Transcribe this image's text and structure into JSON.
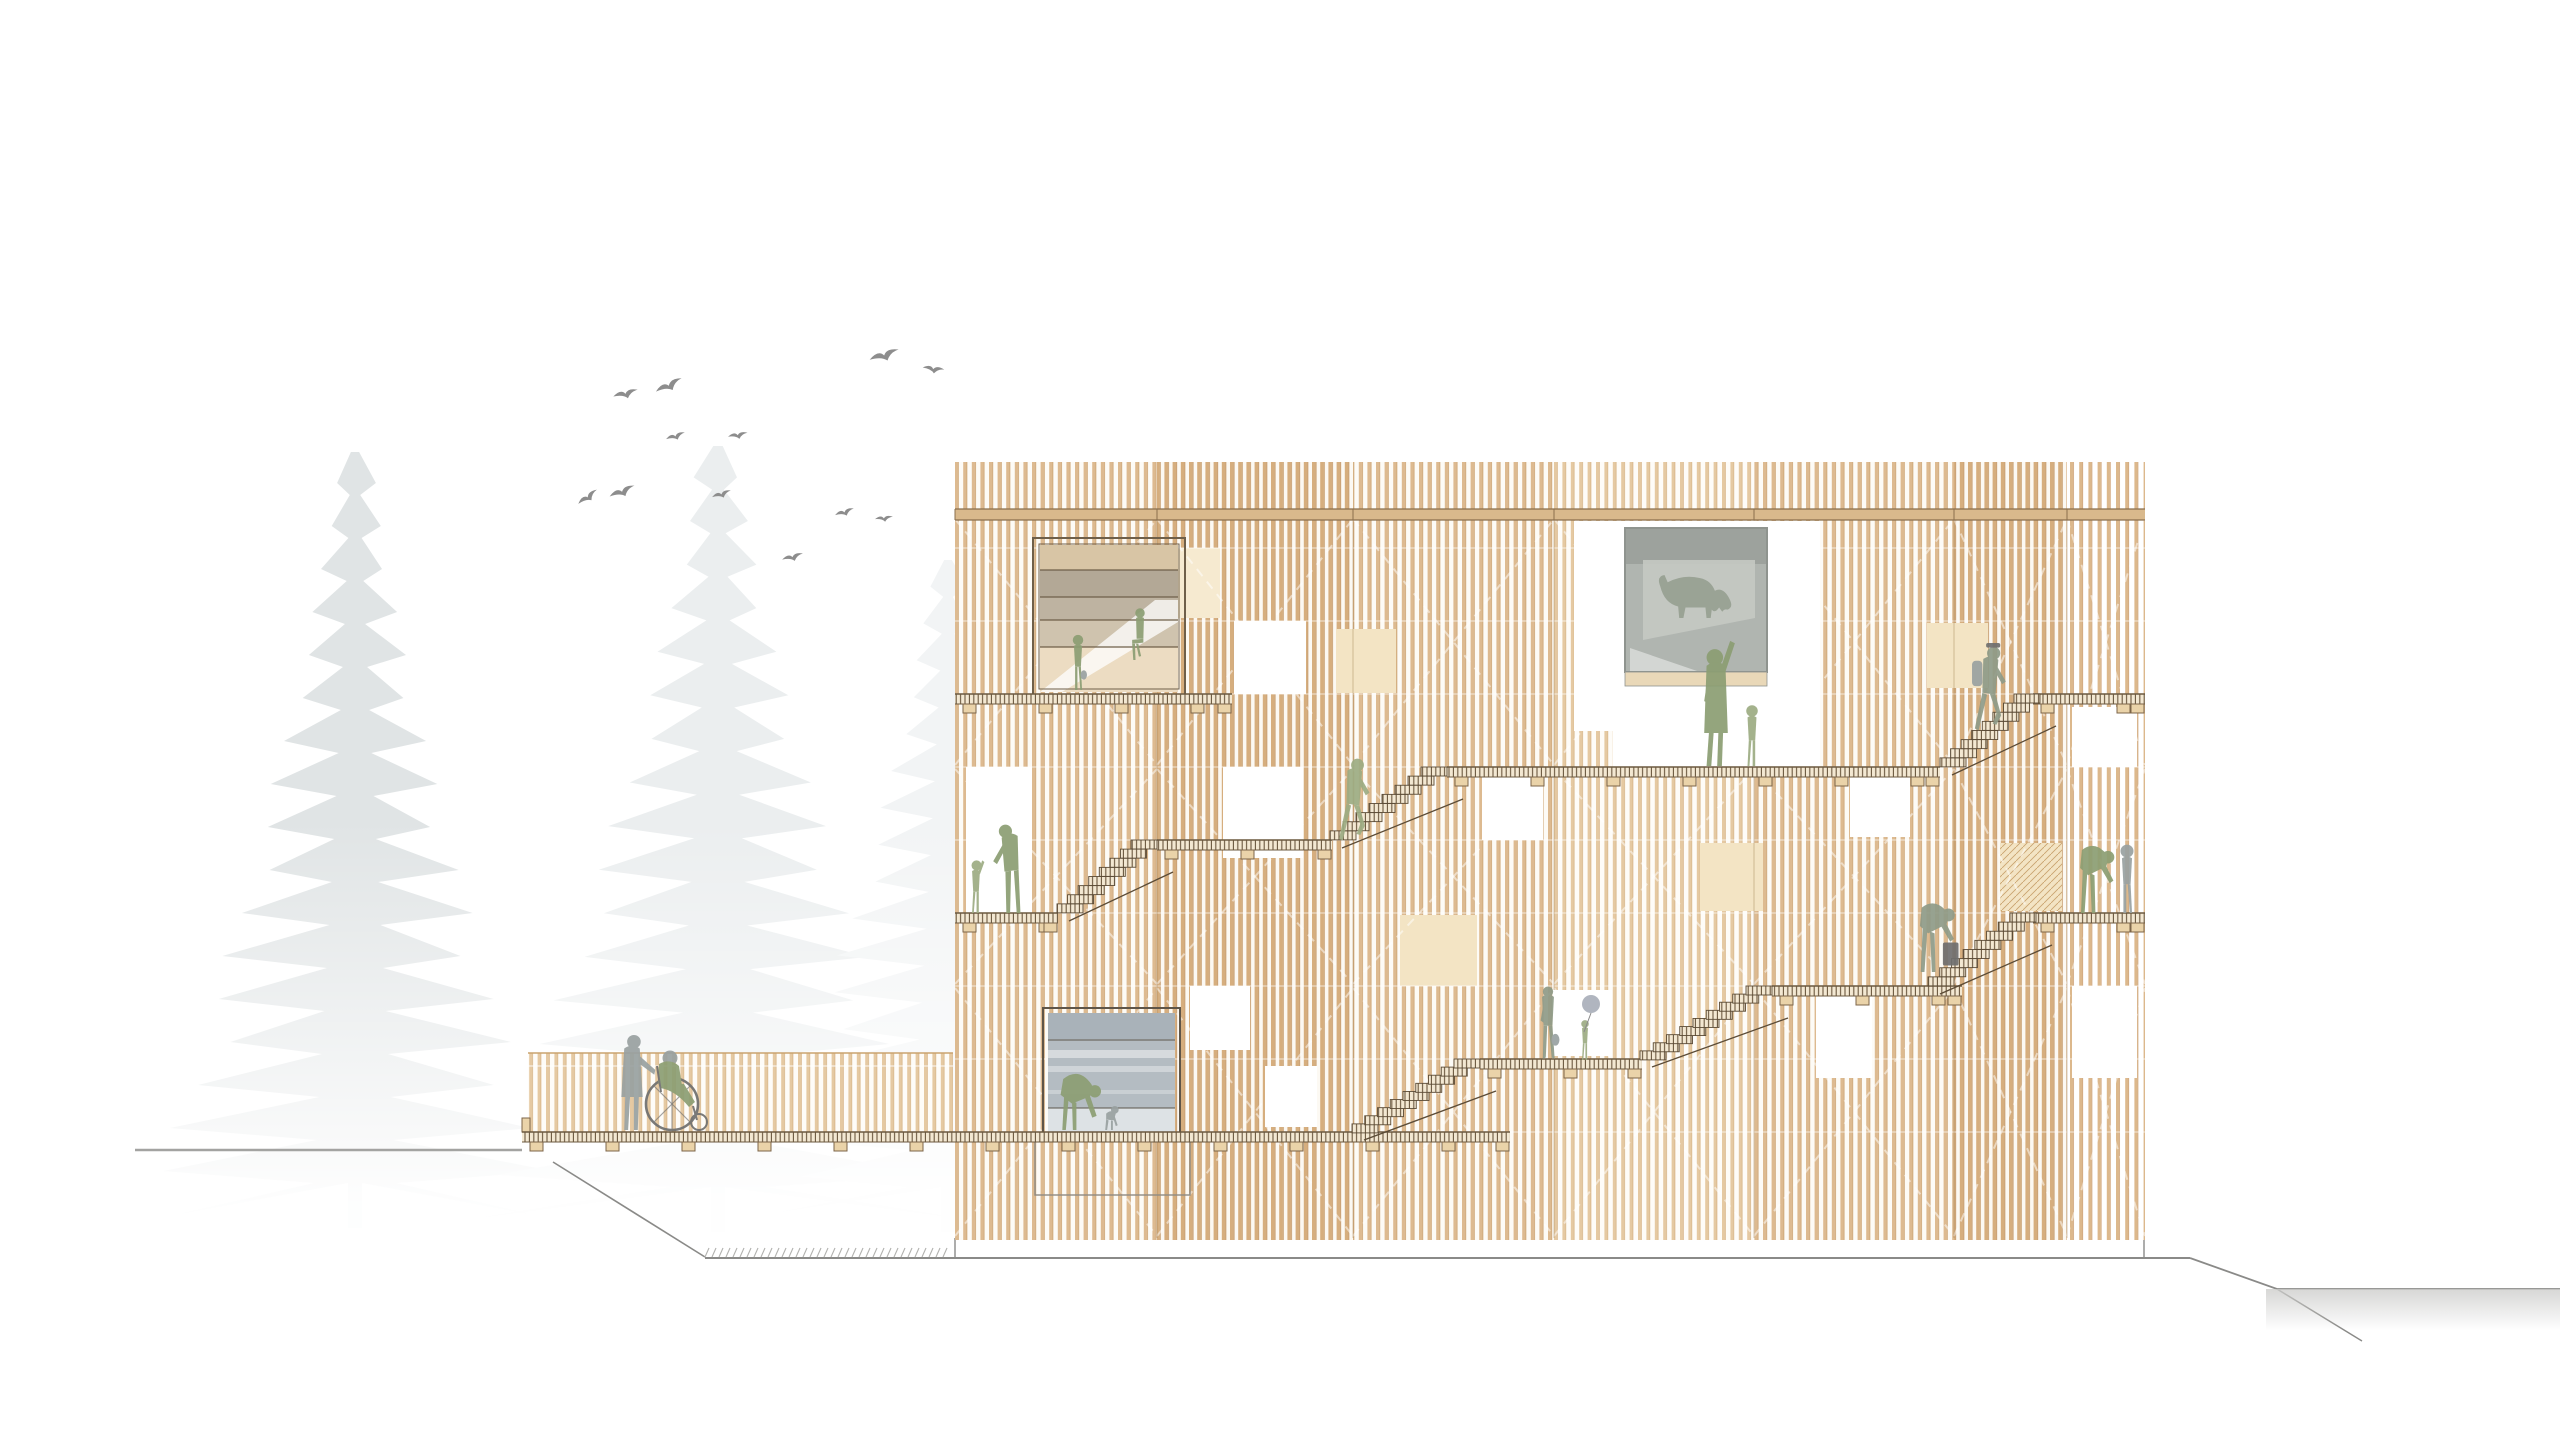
{
  "meta": {
    "title": "Architectural elevation drawing of a timber housing block with external stairs, walkways, trees, birds and an access ramp",
    "canvas": {
      "w": 2560,
      "h": 1440
    }
  },
  "palette": {
    "paper": "#ffffff",
    "bird": "#8d8d8d",
    "ground_light": "#a3a3a1",
    "ground_dark": "#8a8a88",
    "hatch_tick": "#b2b2af",
    "wash_gray": "#cdcdcb",
    "deck_line": "#6b583f",
    "foot_fill": "#ead3a9",
    "foot_line": "#7c6549",
    "stair_line": "#5b4b36",
    "step_fill": "#f8f1e2",
    "beam_fill": "#d9b98c",
    "beam_line": "#8a6f4d",
    "patch_fill": "#f3e4c4",
    "patch_light": "#f6ead0",
    "patch_hatch_line": "#c9a36f",
    "bay_line": "rgba(150,114,70,0.40)",
    "module_line": "rgba(255,255,255,0.55)",
    "brace_line": "rgba(255,255,255,0.50)",
    "railing_top": "#caa36f",
    "figure_colors": {
      "green": "#8c9e73",
      "green2": "#9dac83",
      "gray": "#99a1a1",
      "grayGreen": "#8f9b88",
      "dogGray": "#97a092",
      "dark": "#6f6f6f",
      "balloon": "#a5abb6"
    },
    "slat_patterns": [
      {
        "id": "slatA",
        "period": 8.2,
        "slat_w": 3.6,
        "edge_w": 0.9,
        "slat": "#d6ae7e",
        "edge": "#c2925f",
        "gap": "#fcf9f3"
      },
      {
        "id": "slatB",
        "period": 8.6,
        "slat_w": 3.3,
        "edge_w": 0.8,
        "slat": "#ddba90",
        "edge": "#caa06d",
        "gap": "#fdfbf6"
      },
      {
        "id": "slatC",
        "period": 8.4,
        "slat_w": 3.0,
        "edge_w": 0.7,
        "slat": "#e5c9a2",
        "edge": "#d3ad7c",
        "gap": "#fefcf8"
      },
      {
        "id": "slatD",
        "period": 9.2,
        "slat_w": 3.2,
        "edge_w": 0.7,
        "slat": "#dcb88c",
        "edge": "#c9996a",
        "gap": "#ffffff"
      }
    ],
    "trees": [
      "#e0e4e5",
      "#ebeeef",
      "#f2f4f5"
    ],
    "w1": {
      "frame": "#6f5f49",
      "top_band": "#d8c5a5",
      "band1": "#b3a896",
      "band2": "#beb3a1",
      "band3": "#cfc3ae",
      "base": "#ecdcc2"
    },
    "w2": {
      "frame": "#8f948f",
      "glazing": "#b0b5b0",
      "glazing_top": "#9da29d",
      "reflection": "#c5c9c3",
      "sill": "#e9d8b8"
    },
    "w3": {
      "frame": "#5f5548",
      "glazing": "#b4bcc2",
      "top_band": "#a9b2b9",
      "base_band": "#dde2e5",
      "subframe": "#8f8b83"
    }
  },
  "scene": {
    "trees": [
      {
        "name": "conifer-tree-front",
        "cx": 355,
        "top": 452,
        "base": 1228,
        "half": 205,
        "color_index": 0,
        "seed": 0.3
      },
      {
        "name": "conifer-tree-middle",
        "cx": 718,
        "top": 446,
        "base": 1232,
        "half": 235,
        "color_index": 1,
        "seed": 1.4
      },
      {
        "name": "conifer-tree-back",
        "cx": 948,
        "top": 560,
        "base": 1232,
        "half": 190,
        "color_index": 2,
        "seed": 2.6
      }
    ],
    "mist": {
      "x": 60,
      "y": 820,
      "w": 930,
      "h": 450
    },
    "birds": [
      {
        "x": 885,
        "y": 358,
        "size": 17,
        "rot": 0
      },
      {
        "x": 933,
        "y": 371,
        "size": 12,
        "rot": 25
      },
      {
        "x": 670,
        "y": 388,
        "size": 16,
        "rot": -8
      },
      {
        "x": 626,
        "y": 396,
        "size": 14,
        "rot": 4
      },
      {
        "x": 676,
        "y": 438,
        "size": 11,
        "rot": 0
      },
      {
        "x": 738,
        "y": 437,
        "size": 11,
        "rot": 8
      },
      {
        "x": 589,
        "y": 499,
        "size": 13,
        "rot": -18
      },
      {
        "x": 623,
        "y": 494,
        "size": 15,
        "rot": -4
      },
      {
        "x": 722,
        "y": 496,
        "size": 11,
        "rot": 0
      },
      {
        "x": 845,
        "y": 514,
        "size": 11,
        "rot": 0
      },
      {
        "x": 884,
        "y": 520,
        "size": 10,
        "rot": 12
      },
      {
        "x": 793,
        "y": 559,
        "size": 12,
        "rot": 3
      }
    ],
    "ground": {
      "left_line": {
        "x1": 135,
        "y1": 1150,
        "x2": 522,
        "y2": 1150
      },
      "ramp_slope": {
        "x1": 553,
        "y1": 1162,
        "x2": 705,
        "y2": 1257
      },
      "main_line": {
        "x1": 705,
        "y1": 1258,
        "x2": 2190,
        "y2": 1258
      },
      "right_drop": {
        "points": "2190,1258 2277,1289 2560,1289"
      },
      "spur": {
        "x1": 2277,
        "y1": 1289,
        "x2": 2362,
        "y2": 1341
      },
      "hatch_span": {
        "x1": 705,
        "x2": 948,
        "y": 1257,
        "step": 7,
        "len": 9
      },
      "wash": {
        "x": 2266,
        "y": 1289,
        "w": 294,
        "h": 42
      },
      "edge_left": {
        "x": 955,
        "y1": 1238,
        "y2": 1258
      },
      "edge_right": {
        "x": 2144,
        "y1": 1238,
        "y2": 1258
      }
    },
    "ramp": {
      "railing": {
        "x": 528,
        "y": 1053,
        "w": 425,
        "h": 79
      },
      "highlight_y": 1066,
      "end_post": {
        "x": 522,
        "y": 1118,
        "w": 8,
        "h": 14
      }
    },
    "building": {
      "x": 955,
      "top": 462,
      "right": 2145,
      "slat_bottom": 1240,
      "beam": {
        "y": 509,
        "h": 11
      },
      "bays": [
        {
          "x1": 955,
          "x2": 1157,
          "pattern": "slatB"
        },
        {
          "x1": 1157,
          "x2": 1353,
          "pattern": "slatA"
        },
        {
          "x1": 1353,
          "x2": 1554,
          "pattern": "slatB"
        },
        {
          "x1": 1554,
          "x2": 1754,
          "pattern": "slatC"
        },
        {
          "x1": 1754,
          "x2": 1954,
          "pattern": "slatB"
        },
        {
          "x1": 1954,
          "x2": 2067,
          "pattern": "slatA"
        },
        {
          "x1": 2067,
          "x2": 2145,
          "pattern": "slatD"
        }
      ],
      "module_lines": [
        548,
        621,
        694,
        767,
        840,
        913,
        986,
        1059,
        1132
      ],
      "brace_sections": [
        [
          519,
          765
        ],
        [
          769,
          984
        ],
        [
          988,
          1236
        ]
      ],
      "patches": [
        {
          "x": 1336,
          "y": 629,
          "w": 60,
          "h": 64,
          "hatch": false
        },
        {
          "x": 1400,
          "y": 915,
          "w": 77,
          "h": 71,
          "hatch": false
        },
        {
          "x": 1700,
          "y": 843,
          "w": 63,
          "h": 68,
          "hatch": false
        },
        {
          "x": 1927,
          "y": 623,
          "w": 61,
          "h": 65,
          "hatch": false
        },
        {
          "x": 2000,
          "y": 843,
          "w": 62,
          "h": 68,
          "hatch": true
        },
        {
          "x": 1160,
          "y": 548,
          "w": 60,
          "h": 70,
          "hatch": false,
          "light": true
        }
      ],
      "openings": [
        {
          "name": "opening-left-doorway",
          "x": 966,
          "y": 767,
          "w": 66,
          "h": 146
        },
        {
          "name": "opening-upper-square-1",
          "x": 1234,
          "y": 621,
          "w": 72,
          "h": 73
        },
        {
          "name": "opening-mid-square-1",
          "x": 1223,
          "y": 767,
          "w": 80,
          "h": 91
        },
        {
          "name": "opening-mid-square-2",
          "x": 1482,
          "y": 775,
          "w": 61,
          "h": 65
        },
        {
          "name": "opening-mid-square-3",
          "x": 1850,
          "y": 775,
          "w": 60,
          "h": 62
        },
        {
          "name": "opening-upper-right",
          "x": 2072,
          "y": 707,
          "w": 65,
          "h": 60
        },
        {
          "name": "opening-lower-right-edge",
          "x": 2072,
          "y": 986,
          "w": 65,
          "h": 92
        },
        {
          "name": "opening-lower-square-1",
          "x": 1816,
          "y": 986,
          "w": 56,
          "h": 92
        },
        {
          "name": "opening-lower-square-2",
          "x": 1190,
          "y": 986,
          "w": 60,
          "h": 64
        },
        {
          "name": "opening-lower-square-3",
          "x": 1265,
          "y": 1066,
          "w": 52,
          "h": 61
        },
        {
          "name": "opening-behind-family",
          "x": 1553,
          "y": 990,
          "w": 59,
          "h": 66
        }
      ],
      "window_kids": {
        "frame": {
          "x": 1033,
          "y": 538,
          "w": 152,
          "h": 157
        },
        "glazing": {
          "x": 1040,
          "y": 545,
          "w": 138,
          "h": 147
        },
        "band_ys": [
          570,
          597,
          620,
          647
        ],
        "wedge": "1040,692 1155,600 1178,600 1178,622 1062,692"
      },
      "window_dog": {
        "surround_upper": {
          "x": 1574,
          "y": 521,
          "w": 246,
          "h": 210
        },
        "surround_lower": {
          "x": 1613,
          "y": 660,
          "w": 207,
          "h": 107
        },
        "glazing": {
          "x": 1625,
          "y": 528,
          "w": 142,
          "h": 144
        },
        "top_band_h": 36,
        "reflection": "1643,560 1755,560 1755,618 1643,640",
        "sill": {
          "x": 1625,
          "y": 672,
          "w": 142,
          "h": 14
        }
      },
      "window_playroom": {
        "frame": {
          "x": 1043,
          "y": 1008,
          "w": 137,
          "h": 127
        },
        "glazing": {
          "x": 1048,
          "y": 1013,
          "w": 127,
          "h": 119
        },
        "line_ys": [
          1040,
          1108
        ],
        "streak_ys": [
          1050,
          1066,
          1090
        ],
        "subframe": {
          "x": 1035,
          "y": 1140,
          "w": 155,
          "h": 55
        }
      },
      "walkways": [
        {
          "name": "walkway-top-left",
          "x1": 955,
          "x2": 1232,
          "y": 694
        },
        {
          "name": "walkway-top-right",
          "x1": 2033,
          "x2": 2145,
          "y": 694
        },
        {
          "name": "walkway-level2",
          "x1": 1447,
          "x2": 1940,
          "y": 767
        },
        {
          "name": "walkway-level3",
          "x1": 1157,
          "x2": 1332,
          "y": 840
        },
        {
          "name": "walkway-level4-left",
          "x1": 955,
          "x2": 1058,
          "y": 913
        },
        {
          "name": "walkway-level4-right",
          "x1": 2033,
          "x2": 2145,
          "y": 913
        },
        {
          "name": "walkway-level5",
          "x1": 1772,
          "x2": 1962,
          "y": 986
        },
        {
          "name": "walkway-level6",
          "x1": 1480,
          "x2": 1642,
          "y": 1059
        },
        {
          "name": "walkway-ground-deck",
          "x1": 522,
          "x2": 1510,
          "y": 1132
        }
      ],
      "stairs": [
        {
          "name": "stair-flight-1",
          "x1": 1352,
          "y1": 1132,
          "x2": 1480,
          "y2": 1059,
          "steps": 9
        },
        {
          "name": "stair-flight-2",
          "x1": 1640,
          "y1": 1059,
          "x2": 1772,
          "y2": 986,
          "steps": 9
        },
        {
          "name": "stair-flight-3",
          "x1": 1928,
          "y1": 986,
          "x2": 2036,
          "y2": 913,
          "steps": 8
        },
        {
          "name": "stair-flight-4",
          "x1": 1057,
          "y1": 913,
          "x2": 1157,
          "y2": 840,
          "steps": 8
        },
        {
          "name": "stair-flight-5",
          "x1": 1330,
          "y1": 840,
          "x2": 1447,
          "y2": 767,
          "steps": 8
        },
        {
          "name": "stair-flight-6",
          "x1": 1940,
          "y1": 767,
          "x2": 2040,
          "y2": 694,
          "steps": 8
        }
      ]
    },
    "figures": [
      {
        "name": "girl-standing-in-window",
        "pose": "child_stand",
        "x": 1078,
        "y": 690,
        "h": 58,
        "color": "green",
        "flip": true,
        "props": [
          "bag"
        ]
      },
      {
        "name": "boy-sitting-on-ledge",
        "pose": "child_sit",
        "x": 1140,
        "y": 660,
        "h": 56,
        "color": "green",
        "flip": true
      },
      {
        "name": "waving-child",
        "pose": "child_wave",
        "x": 976,
        "y": 913,
        "h": 56,
        "color": "green2"
      },
      {
        "name": "parent-greeting-child",
        "pose": "adult_lean",
        "x": 1012,
        "y": 913,
        "h": 94,
        "color": "green",
        "flip": true
      },
      {
        "name": "resident-climbing-stairs",
        "pose": "adult_climb",
        "x": 1352,
        "y": 846,
        "h": 92,
        "color": "green2"
      },
      {
        "name": "mother-at-dog-window",
        "pose": "adult_reach",
        "x": 1716,
        "y": 766,
        "h": 118,
        "color": "green"
      },
      {
        "name": "child-at-dog-window",
        "pose": "child_stand",
        "x": 1752,
        "y": 766,
        "h": 64,
        "color": "green2"
      },
      {
        "name": "dog-in-window",
        "pose": "dog",
        "x": 1696,
        "y": 618,
        "h": 42,
        "color": "dogGray"
      },
      {
        "name": "hiker-with-backpack",
        "pose": "adult_climb",
        "x": 1988,
        "y": 736,
        "h": 94,
        "color": "grayGreen",
        "props": [
          "backpack",
          "cap"
        ]
      },
      {
        "name": "traveler-with-suitcase",
        "pose": "adult_bend",
        "x": 1930,
        "y": 972,
        "h": 92,
        "color": "grayGreen",
        "props": [
          "suitcase"
        ]
      },
      {
        "name": "grandparent-helping-child",
        "pose": "adult_bend",
        "x": 2090,
        "y": 913,
        "h": 90,
        "color": "green"
      },
      {
        "name": "child-being-helped",
        "pose": "child_stand",
        "x": 2127,
        "y": 913,
        "h": 72,
        "color": "gray",
        "flip": true
      },
      {
        "name": "parent-with-bag",
        "pose": "adult_stand",
        "x": 1548,
        "y": 1059,
        "h": 74,
        "color": "grayGreen",
        "flip": true,
        "props": [
          "bag"
        ]
      },
      {
        "name": "child-with-balloon",
        "pose": "child_stand",
        "x": 1585,
        "y": 1060,
        "h": 42,
        "color": "green2"
      },
      {
        "name": "person-bending-in-window",
        "pose": "adult_deepbend",
        "x": 1072,
        "y": 1130,
        "h": 88,
        "color": "green"
      },
      {
        "name": "toddler-in-window",
        "pose": "child_crouch",
        "x": 1110,
        "y": 1130,
        "h": 48,
        "color": "gray"
      },
      {
        "name": "companion-pushing-wheelchair",
        "pose": "adult_push",
        "x": 632,
        "y": 1130,
        "h": 97,
        "color": "gray"
      },
      {
        "name": "wheelchair-user",
        "pose": "wheelchair",
        "x": 672,
        "y": 1130,
        "h": 85,
        "color": "green"
      }
    ],
    "balloon": {
      "cx": 1591,
      "cy": 1004,
      "r": 9,
      "hand_x": 1584,
      "hand_y": 1032
    }
  }
}
